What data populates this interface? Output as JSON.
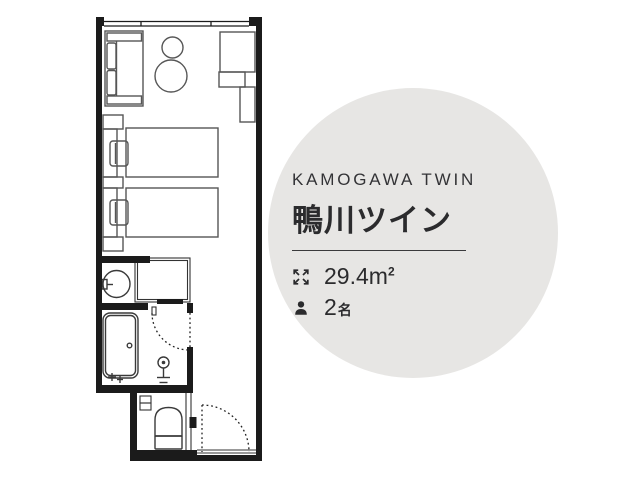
{
  "room_card": {
    "name_en": "KAMOGAWA TWIN",
    "name_ja": "鴨川ツイン",
    "specs": {
      "area": {
        "icon": "expand-icon",
        "value": "29.4",
        "unit_base": "m",
        "unit_exponent": "2"
      },
      "capacity": {
        "icon": "person-icon",
        "value": "2",
        "unit": "名"
      }
    }
  },
  "floorplan": {
    "rooms": [
      "bedroom",
      "washbasin-area",
      "closet",
      "bathroom",
      "toilet",
      "entrance-corridor"
    ],
    "features": [
      "window",
      "sofa",
      "side-table",
      "round-table",
      "desk",
      "counter",
      "twin-bed-1",
      "twin-bed-2",
      "pillows",
      "nightstand",
      "hanger-rail",
      "washbasin",
      "bathtub",
      "shower",
      "toilet",
      "bathroom-door-swing",
      "entrance-door-swing"
    ]
  },
  "colors": {
    "background": "#ffffff",
    "circle_background": "#e7e6e4",
    "ink": "#2c2c2e",
    "wall": "#1b1b1b",
    "furniture_line": "#565656",
    "fixture_line": "#3a3a3a"
  }
}
